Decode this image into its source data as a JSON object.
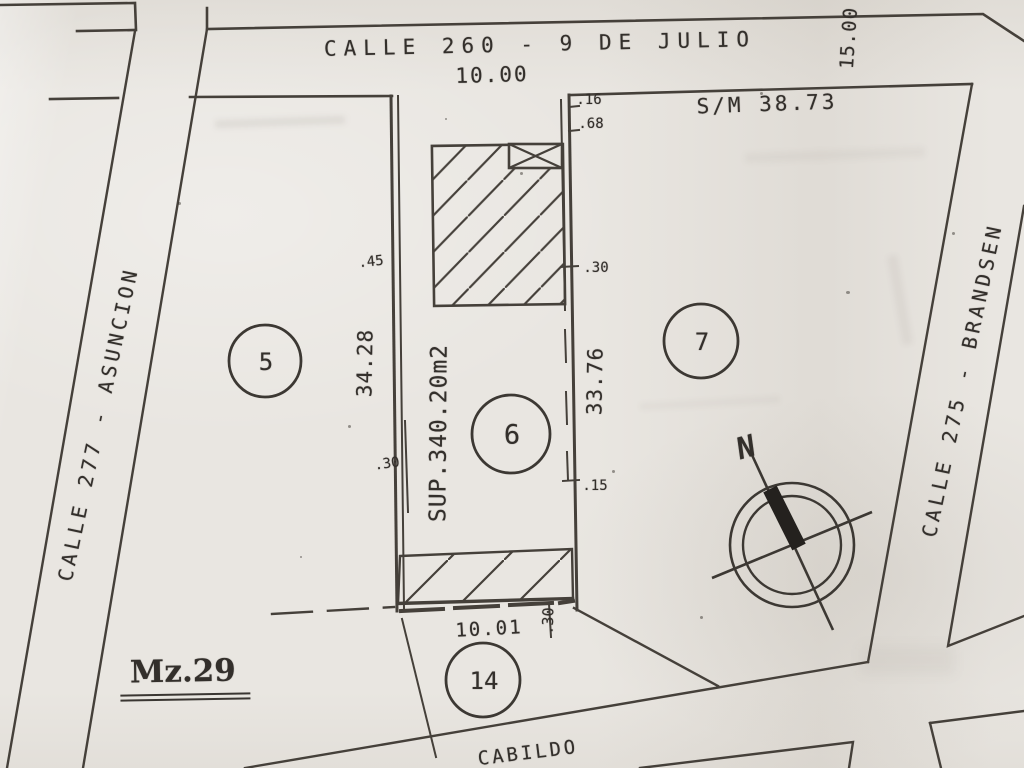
{
  "document_type": "cadastral survey plan (scan)",
  "streets": {
    "top": "CALLE 260 - 9 DE JULIO",
    "left": "CALLE 277 - ASUNCION",
    "right": "CALLE 275 - BRANDSEN",
    "bottom": "CABILDO"
  },
  "block": {
    "label": "Mz.29"
  },
  "lot": {
    "number": "6",
    "front_width": "10.00",
    "rear_width": "10.01",
    "left_depth": "34.28",
    "right_depth": "33.76",
    "area": "SUP.340.20m2"
  },
  "parcels": {
    "p5": "5",
    "p7": "7",
    "p14": "14"
  },
  "annotations": {
    "survey_note": "S/M 38.73",
    "corner_distance": "15.00",
    "north": "N"
  },
  "offsets": {
    "top_right_a": ".16",
    "top_right_b": ".68",
    "left_upper": ".45",
    "left_lower": ".30",
    "right_upper": ".30",
    "right_lower": ".15",
    "rear": ".30"
  },
  "colors": {
    "paper": "#e9e6e1",
    "ink": "#45403a",
    "text_ink": "#332f2b"
  }
}
